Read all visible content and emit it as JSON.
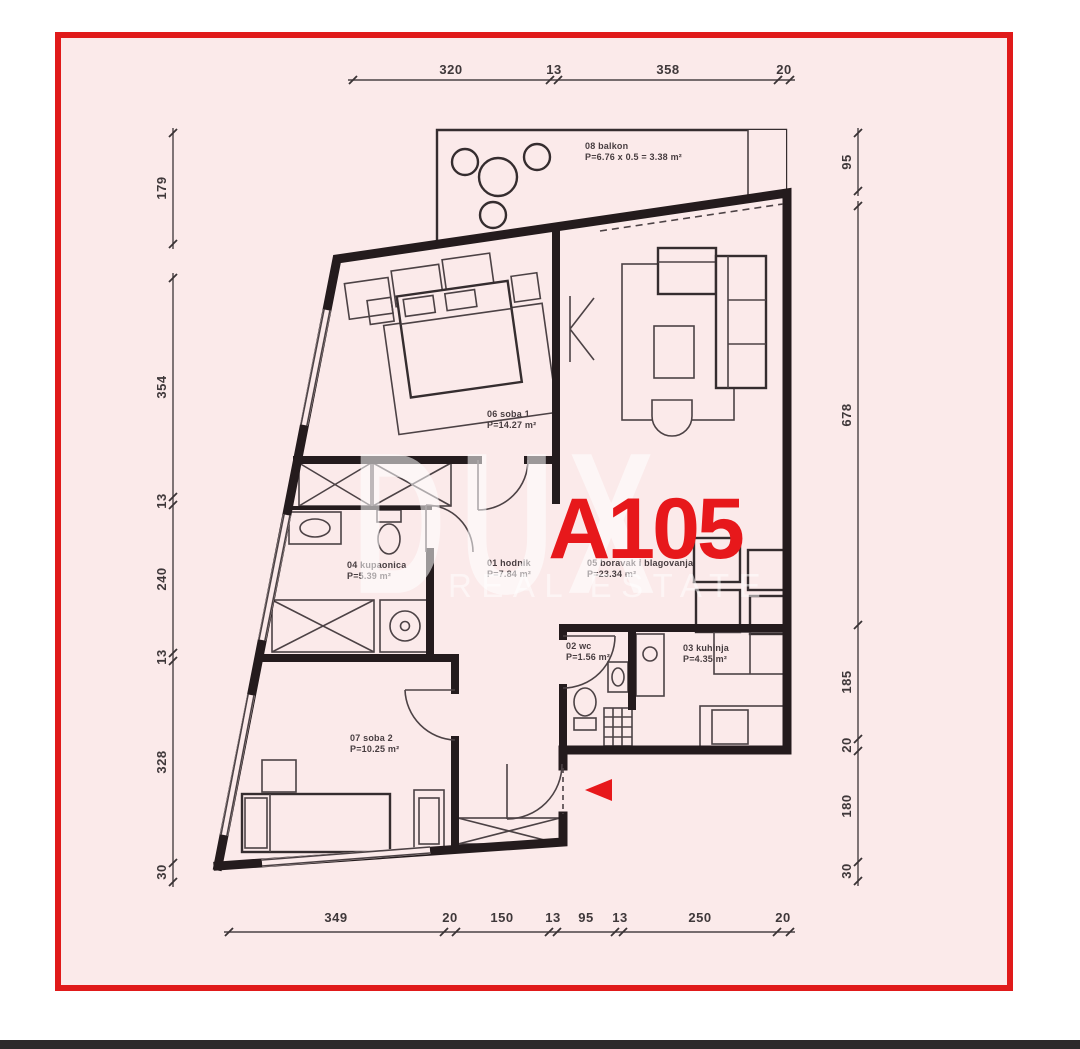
{
  "title": {
    "unit": "A105"
  },
  "watermark": {
    "brand": "DUX",
    "tagline": "REAL ESTATE"
  },
  "rooms": [
    {
      "code_name": "01 hodnik",
      "area": "P=7.84 m²"
    },
    {
      "code_name": "02 wc",
      "area": "P=1.56 m²"
    },
    {
      "code_name": "03 kuhinja",
      "area": "P=4.35 m²"
    },
    {
      "code_name": "04 kupaonica",
      "area": "P=5.39 m²"
    },
    {
      "code_name": "05 boravak i blagovanja",
      "area": "P=23.34 m²"
    },
    {
      "code_name": "06 soba 1",
      "area": "P=14.27 m²"
    },
    {
      "code_name": "07 soba 2",
      "area": "P=10.25 m²"
    },
    {
      "code_name": "08 balkon",
      "area": "P=6.76 x 0.5 = 3.38 m²"
    }
  ],
  "dimensions": {
    "top": [
      "320",
      "13",
      "358",
      "20"
    ],
    "left": [
      "179",
      "354",
      "13",
      "240",
      "13",
      "328",
      "30"
    ],
    "right": [
      "95",
      "678",
      "185",
      "20",
      "180",
      "30"
    ],
    "bottom": [
      "349",
      "20",
      "150",
      "13",
      "95",
      "13",
      "250",
      "20"
    ]
  },
  "colors": {
    "frame_red": "#e01a1a",
    "plan_background": "#fbeaea",
    "wall_black": "#241b1d",
    "accent_red": "#e7181b",
    "watermark_white": "#ffffff",
    "bottom_bar": "#2d2a2b"
  }
}
